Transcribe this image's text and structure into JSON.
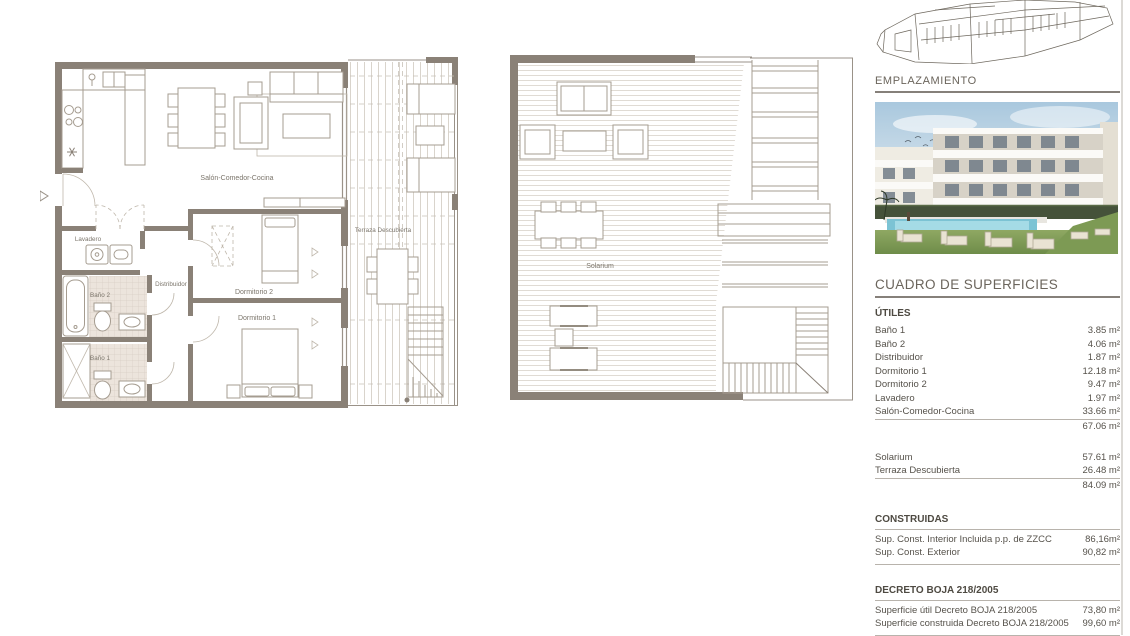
{
  "plans": {
    "plan1": {
      "unit_label": "B2",
      "rooms": {
        "salon": "Salón-Comedor-Cocina",
        "dormitorio1": "Dormitorio 1",
        "dormitorio2": "Dormitorio 2",
        "bano1": "Baño 1",
        "bano2": "Baño 2",
        "lavadero": "Lavadero",
        "distribuidor": "Distribuidor",
        "terraza": "Terraza Descubierta"
      }
    },
    "plan2": {
      "rooms": {
        "solarium": "Solarium"
      }
    }
  },
  "sidebar": {
    "emplazamiento_title": "EMPLAZAMIENTO",
    "surfaces_title": "CUADRO DE SUPERFICIES",
    "utiles": {
      "title": "ÚTILES",
      "rows": [
        {
          "label": "Baño 1",
          "value": "3.85 m²"
        },
        {
          "label": "Baño 2",
          "value": "4.06 m²"
        },
        {
          "label": "Distribuidor",
          "value": "1.87 m²"
        },
        {
          "label": "Dormitorio 1",
          "value": "12.18 m²"
        },
        {
          "label": "Dormitorio 2",
          "value": "9.47 m²"
        },
        {
          "label": "Lavadero",
          "value": "1.97 m²"
        },
        {
          "label": "Salón-Comedor-Cocina",
          "value": "33.66 m²"
        }
      ],
      "total": "67.06 m²"
    },
    "exterior": {
      "rows": [
        {
          "label": "Solarium",
          "value": "57.61 m²"
        },
        {
          "label": "Terraza Descubierta",
          "value": "26.48 m²"
        }
      ],
      "total": "84.09 m²"
    },
    "construidas": {
      "title": "CONSTRUIDAS",
      "rows": [
        {
          "label": "Sup. Const. Interior Incluida p.p. de ZZCC",
          "value": "86,16m²"
        },
        {
          "label": "Sup. Const. Exterior",
          "value": "90,82 m²"
        }
      ]
    },
    "decreto": {
      "title": "DECRETO BOJA 218/2005",
      "rows": [
        {
          "label": "Superficie útil Decreto BOJA 218/2005",
          "value": "73,80 m²"
        },
        {
          "label": "Superficie construida Decreto BOJA 218/2005",
          "value": "99,60 m²"
        }
      ]
    }
  },
  "colors": {
    "wall": "#8a8177",
    "fixture_line": "#a59c90",
    "tile_fill": "#ece4dc",
    "deck_line": "#d5cfc6",
    "plan_label": "#7b756b",
    "heading": "#6b655c",
    "rule": "#86807a",
    "table_text": "#56524b",
    "photo_sky": "#a9c8de",
    "photo_pool": "#7cc3d4",
    "photo_lawn": "#7e9c55",
    "photo_hedge": "#45523a"
  }
}
